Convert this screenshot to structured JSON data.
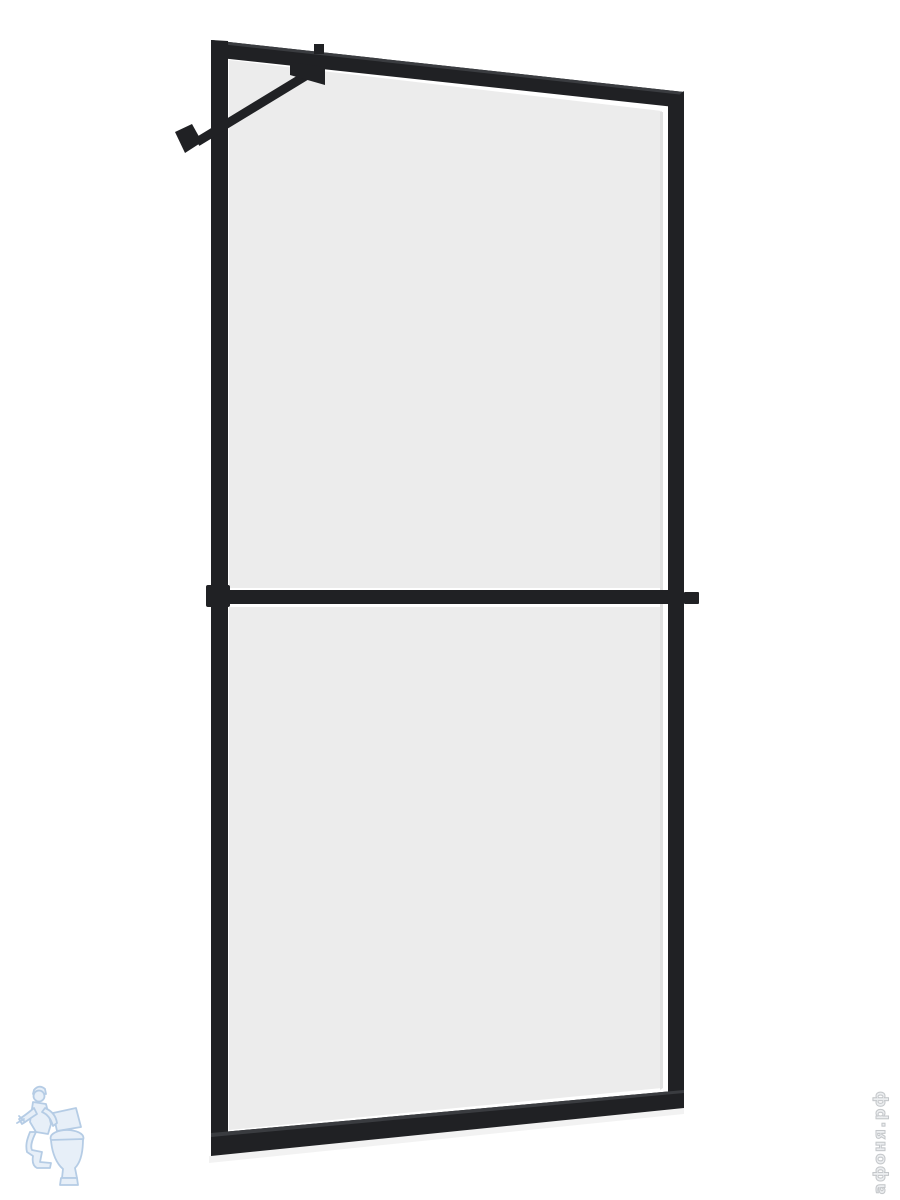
{
  "colors": {
    "background": "#ffffff",
    "frame": "#202124",
    "frame-hl": "#3a3c40",
    "glass": "#ececec",
    "glass-edge": "#e0e0e0",
    "logo-stroke": "#a9c4e1",
    "logo-fill": "#e3edf7",
    "watermark-fill": "#eceef0",
    "watermark-stroke": "#c4c7ca"
  },
  "watermark": {
    "site_text": "афоня.рф"
  },
  "image": {
    "subject": "black-framed walk-in shower glass screen with two frosted panels, wall support bar and middle crossbar"
  }
}
